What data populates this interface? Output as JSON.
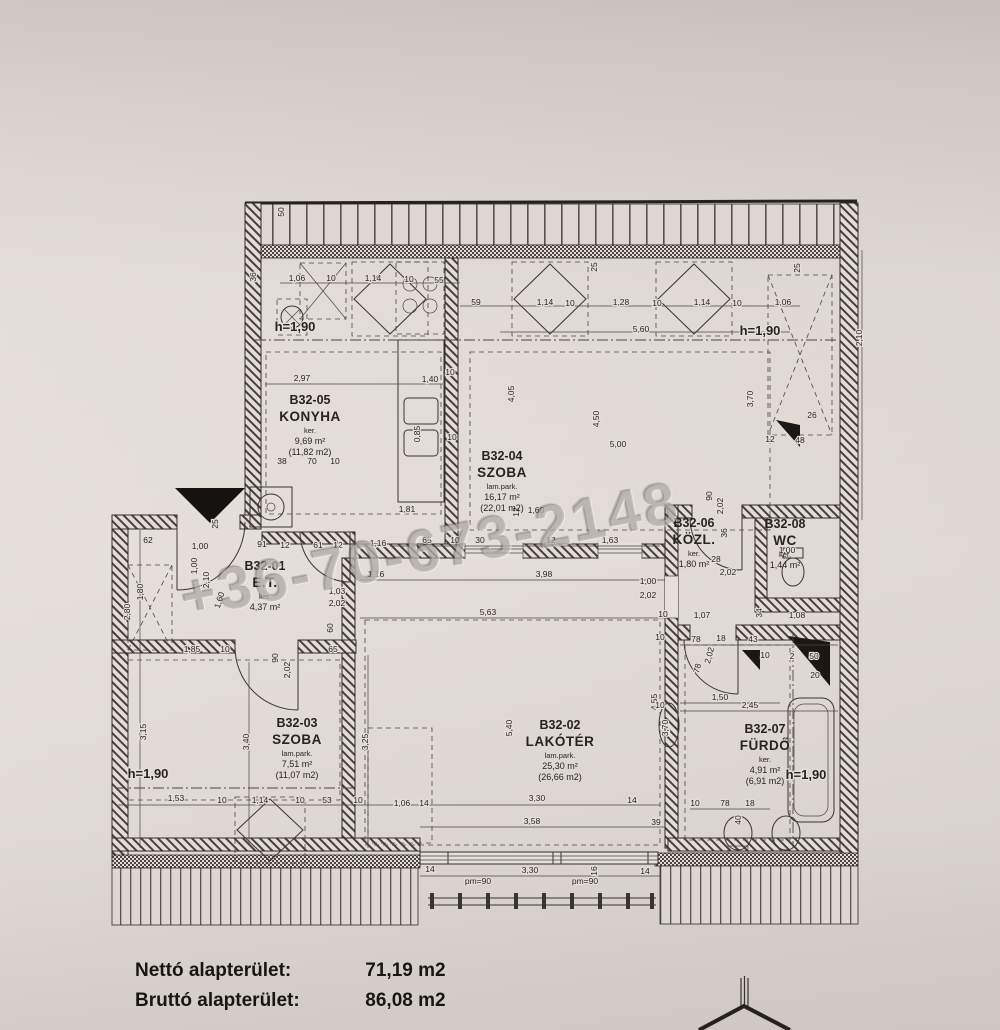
{
  "page": {
    "watermark": "+36-70-673-2148",
    "summary": {
      "rows": [
        {
          "label": "Nettó alapterület:",
          "value": "71,19 m2"
        },
        {
          "label": "Bruttó alapterület:",
          "value": "86,08 m2"
        }
      ]
    }
  },
  "plan": {
    "rooms": [
      {
        "id": "B32-01",
        "name": "E.T.",
        "floor": "ker.",
        "area": "4,37 m²",
        "gross": "",
        "x": 265,
        "y": 570
      },
      {
        "id": "B32-02",
        "name": "LAKÓTÉR",
        "floor": "lam.park.",
        "area": "25,30 m²",
        "gross": "(26,66 m2)",
        "x": 560,
        "y": 729
      },
      {
        "id": "B32-03",
        "name": "SZOBA",
        "floor": "lam.park.",
        "area": "7,51 m²",
        "gross": "(11,07 m2)",
        "x": 297,
        "y": 727
      },
      {
        "id": "B32-04",
        "name": "SZOBA",
        "floor": "lam.park.",
        "area": "16,17 m²",
        "gross": "(22,01 m2)",
        "x": 502,
        "y": 460
      },
      {
        "id": "B32-05",
        "name": "KONYHA",
        "floor": "ker.",
        "area": "9,69 m²",
        "gross": "(11,82 m2)",
        "x": 310,
        "y": 404
      },
      {
        "id": "B32-06",
        "name": "KÖZL.",
        "floor": "ker.",
        "area": "1,80 m²",
        "gross": "",
        "x": 694,
        "y": 527
      },
      {
        "id": "B32-07",
        "name": "FÜRDŐ",
        "floor": "ker.",
        "area": "4,91 m²",
        "gross": "(6,91 m2)",
        "x": 765,
        "y": 733
      },
      {
        "id": "B32-08",
        "name": "WC",
        "floor": "ker.",
        "area": "1,44 m²",
        "gross": "",
        "x": 785,
        "y": 528
      }
    ],
    "heights": [
      {
        "t": "h=1,90",
        "x": 295,
        "y": 331
      },
      {
        "t": "h=1,90",
        "x": 760,
        "y": 335
      },
      {
        "t": "h=1,90",
        "x": 148,
        "y": 778
      },
      {
        "t": "h=1,90",
        "x": 806,
        "y": 779
      }
    ],
    "dimensions": [
      {
        "t": "50",
        "x": 284,
        "y": 212,
        "r": -90
      },
      {
        "t": "36",
        "x": 256,
        "y": 277,
        "r": -90
      },
      {
        "t": "1,06",
        "x": 297,
        "y": 281
      },
      {
        "t": "10",
        "x": 331,
        "y": 281
      },
      {
        "t": "1,14",
        "x": 373,
        "y": 281
      },
      {
        "t": "10",
        "x": 409,
        "y": 282
      },
      {
        "t": "55",
        "x": 439,
        "y": 283
      },
      {
        "t": "59",
        "x": 476,
        "y": 305
      },
      {
        "t": "25",
        "x": 597,
        "y": 267,
        "r": -90
      },
      {
        "t": "25",
        "x": 800,
        "y": 268,
        "r": -90
      },
      {
        "t": "1,14",
        "x": 545,
        "y": 305
      },
      {
        "t": "10",
        "x": 570,
        "y": 306
      },
      {
        "t": "1,28",
        "x": 621,
        "y": 305
      },
      {
        "t": "10",
        "x": 657,
        "y": 306
      },
      {
        "t": "1,14",
        "x": 702,
        "y": 305
      },
      {
        "t": "10",
        "x": 737,
        "y": 306
      },
      {
        "t": "1,06",
        "x": 783,
        "y": 305
      },
      {
        "t": "5,60",
        "x": 641,
        "y": 332
      },
      {
        "t": "2,97",
        "x": 302,
        "y": 381
      },
      {
        "t": "1,40",
        "x": 430,
        "y": 382
      },
      {
        "t": "10",
        "x": 450,
        "y": 375
      },
      {
        "t": "4,05",
        "x": 514,
        "y": 394,
        "r": -90
      },
      {
        "t": "4,50",
        "x": 599,
        "y": 419,
        "r": -90
      },
      {
        "t": "5,00",
        "x": 618,
        "y": 447
      },
      {
        "t": "0,85",
        "x": 420,
        "y": 434,
        "r": -90
      },
      {
        "t": "10",
        "x": 452,
        "y": 440
      },
      {
        "t": "1,81",
        "x": 407,
        "y": 512
      },
      {
        "t": "2,10",
        "x": 862,
        "y": 338,
        "r": -90
      },
      {
        "t": "3,70",
        "x": 753,
        "y": 399,
        "r": -90
      },
      {
        "t": "26",
        "x": 812,
        "y": 418
      },
      {
        "t": "12",
        "x": 770,
        "y": 442
      },
      {
        "t": "48",
        "x": 800,
        "y": 443
      },
      {
        "t": "38",
        "x": 282,
        "y": 464
      },
      {
        "t": "70",
        "x": 312,
        "y": 464
      },
      {
        "t": "10",
        "x": 335,
        "y": 464
      },
      {
        "t": "61",
        "x": 318,
        "y": 548
      },
      {
        "t": "12",
        "x": 338,
        "y": 548
      },
      {
        "t": "65",
        "x": 427,
        "y": 543
      },
      {
        "t": "10",
        "x": 455,
        "y": 543
      },
      {
        "t": "30",
        "x": 480,
        "y": 543
      },
      {
        "t": "12",
        "x": 551,
        "y": 543
      },
      {
        "t": "1,63",
        "x": 610,
        "y": 543
      },
      {
        "t": "1,60",
        "x": 536,
        "y": 513
      },
      {
        "t": "12",
        "x": 519,
        "y": 512,
        "r": -90
      },
      {
        "t": "1,16",
        "x": 378,
        "y": 546
      },
      {
        "t": "1,16",
        "x": 376,
        "y": 577
      },
      {
        "t": "3,98",
        "x": 544,
        "y": 577
      },
      {
        "t": "1,00",
        "x": 648,
        "y": 584
      },
      {
        "t": "2,02",
        "x": 648,
        "y": 598
      },
      {
        "t": "5,63",
        "x": 488,
        "y": 615
      },
      {
        "t": "1,03",
        "x": 337,
        "y": 594
      },
      {
        "t": "2,02",
        "x": 337,
        "y": 606
      },
      {
        "t": "1,00",
        "x": 200,
        "y": 549
      },
      {
        "t": "91",
        "x": 262,
        "y": 547
      },
      {
        "t": "12",
        "x": 285,
        "y": 548
      },
      {
        "t": "62",
        "x": 148,
        "y": 543
      },
      {
        "t": "25",
        "x": 218,
        "y": 524,
        "r": -90
      },
      {
        "t": "1,00",
        "x": 197,
        "y": 566,
        "r": -90
      },
      {
        "t": "2,10",
        "x": 209,
        "y": 580,
        "r": -90
      },
      {
        "t": "1,60",
        "x": 222,
        "y": 601,
        "r": -72
      },
      {
        "t": "2,80",
        "x": 130,
        "y": 612,
        "r": -90
      },
      {
        "t": "1,80",
        "x": 143,
        "y": 592,
        "r": -90
      },
      {
        "t": "60",
        "x": 333,
        "y": 628,
        "r": -90
      },
      {
        "t": "1,85",
        "x": 192,
        "y": 652
      },
      {
        "t": "10",
        "x": 225,
        "y": 652
      },
      {
        "t": "90",
        "x": 278,
        "y": 658,
        "r": -90
      },
      {
        "t": "2,02",
        "x": 290,
        "y": 670,
        "r": -90
      },
      {
        "t": "65",
        "x": 333,
        "y": 652
      },
      {
        "t": "3,15",
        "x": 146,
        "y": 732,
        "r": -90
      },
      {
        "t": "3,40",
        "x": 249,
        "y": 742,
        "r": -90
      },
      {
        "t": "3,25",
        "x": 368,
        "y": 742,
        "r": -90
      },
      {
        "t": "1,53",
        "x": 176,
        "y": 801
      },
      {
        "t": "10",
        "x": 222,
        "y": 803
      },
      {
        "t": "1,14",
        "x": 260,
        "y": 803
      },
      {
        "t": "10",
        "x": 300,
        "y": 803
      },
      {
        "t": "53",
        "x": 327,
        "y": 803
      },
      {
        "t": "10",
        "x": 358,
        "y": 803
      },
      {
        "t": "5,40",
        "x": 512,
        "y": 728,
        "r": -90
      },
      {
        "t": "4,55",
        "x": 657,
        "y": 702,
        "r": -90
      },
      {
        "t": "1,06",
        "x": 402,
        "y": 806
      },
      {
        "t": "14",
        "x": 424,
        "y": 806
      },
      {
        "t": "3,30",
        "x": 537,
        "y": 801
      },
      {
        "t": "14",
        "x": 632,
        "y": 803
      },
      {
        "t": "3,58",
        "x": 532,
        "y": 824
      },
      {
        "t": "39",
        "x": 656,
        "y": 825
      },
      {
        "t": "14",
        "x": 430,
        "y": 872
      },
      {
        "t": "3,30",
        "x": 530,
        "y": 873
      },
      {
        "t": "16",
        "x": 597,
        "y": 871,
        "r": -90
      },
      {
        "t": "14",
        "x": 645,
        "y": 874
      },
      {
        "t": "pm=90",
        "x": 478,
        "y": 884
      },
      {
        "t": "pm=90",
        "x": 585,
        "y": 884
      },
      {
        "t": "90",
        "x": 712,
        "y": 496,
        "r": -90
      },
      {
        "t": "2,02",
        "x": 723,
        "y": 506,
        "r": -90
      },
      {
        "t": "36",
        "x": 727,
        "y": 533,
        "r": -90
      },
      {
        "t": "28",
        "x": 716,
        "y": 562
      },
      {
        "t": "2,02",
        "x": 728,
        "y": 575
      },
      {
        "t": "1,00",
        "x": 787,
        "y": 553
      },
      {
        "t": "10",
        "x": 663,
        "y": 617
      },
      {
        "t": "1,07",
        "x": 702,
        "y": 618
      },
      {
        "t": "34",
        "x": 762,
        "y": 613,
        "r": -90
      },
      {
        "t": "1,08",
        "x": 797,
        "y": 618
      },
      {
        "t": "10",
        "x": 660,
        "y": 640
      },
      {
        "t": "78",
        "x": 696,
        "y": 642
      },
      {
        "t": "18",
        "x": 721,
        "y": 641
      },
      {
        "t": "43",
        "x": 753,
        "y": 642
      },
      {
        "t": "2,02",
        "x": 712,
        "y": 656,
        "r": -75
      },
      {
        "t": "78",
        "x": 700,
        "y": 669,
        "r": -75
      },
      {
        "t": "10",
        "x": 765,
        "y": 658
      },
      {
        "t": "2",
        "x": 792,
        "y": 659
      },
      {
        "t": "50",
        "x": 814,
        "y": 659
      },
      {
        "t": "20",
        "x": 815,
        "y": 678
      },
      {
        "t": "1,50",
        "x": 720,
        "y": 700
      },
      {
        "t": "2,45",
        "x": 750,
        "y": 708
      },
      {
        "t": "10",
        "x": 660,
        "y": 708
      },
      {
        "t": "3,70",
        "x": 668,
        "y": 728,
        "r": -90
      },
      {
        "t": "10",
        "x": 695,
        "y": 806
      },
      {
        "t": "78",
        "x": 725,
        "y": 806
      },
      {
        "t": "18",
        "x": 750,
        "y": 806
      },
      {
        "t": "40",
        "x": 741,
        "y": 820,
        "r": -90
      }
    ]
  }
}
